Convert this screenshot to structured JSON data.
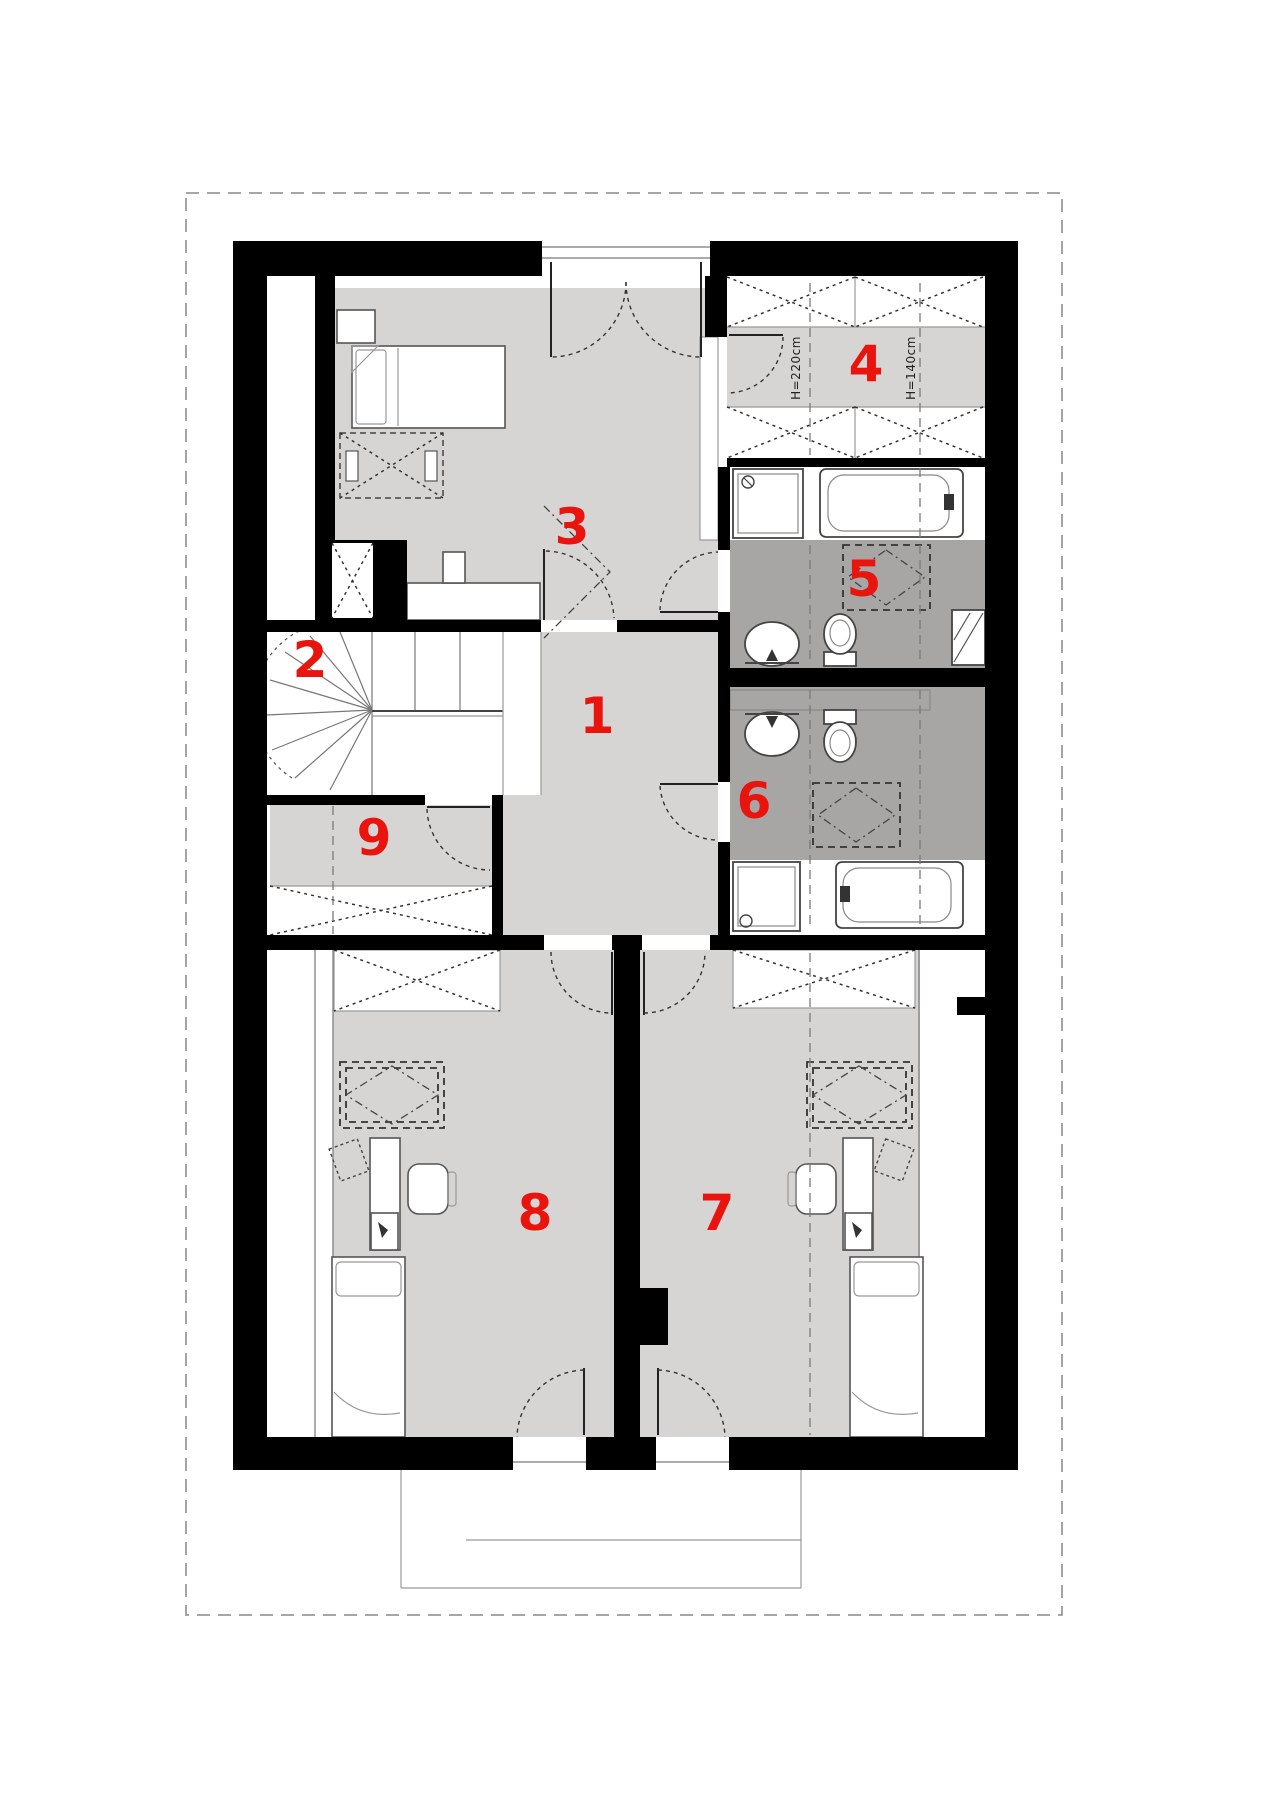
{
  "plan": {
    "title": "attic floor plan",
    "room_labels": [
      {
        "id": "1",
        "text": "1",
        "x": 597,
        "y": 716
      },
      {
        "id": "2",
        "text": "2",
        "x": 310,
        "y": 660
      },
      {
        "id": "3",
        "text": "3",
        "x": 572,
        "y": 527
      },
      {
        "id": "4",
        "text": "4",
        "x": 866,
        "y": 364
      },
      {
        "id": "5",
        "text": "5",
        "x": 864,
        "y": 579
      },
      {
        "id": "6",
        "text": "6",
        "x": 754,
        "y": 801
      },
      {
        "id": "7",
        "text": "7",
        "x": 717,
        "y": 1213
      },
      {
        "id": "8",
        "text": "8",
        "x": 535,
        "y": 1213
      },
      {
        "id": "9",
        "text": "9",
        "x": 374,
        "y": 838
      }
    ],
    "annotations": [
      {
        "id": "height-220",
        "text": "H=220cm",
        "x": 796,
        "y": 368,
        "rotation": -90
      },
      {
        "id": "height-140",
        "text": "H=140cm",
        "x": 911,
        "y": 368,
        "rotation": -90
      }
    ],
    "colors": {
      "wall": "#000000",
      "floor_light": "#d7d5d3",
      "floor_dark": "#a7a6a5",
      "label_red": "#e8140d",
      "boundary_dash": "#9a9a9a"
    }
  }
}
